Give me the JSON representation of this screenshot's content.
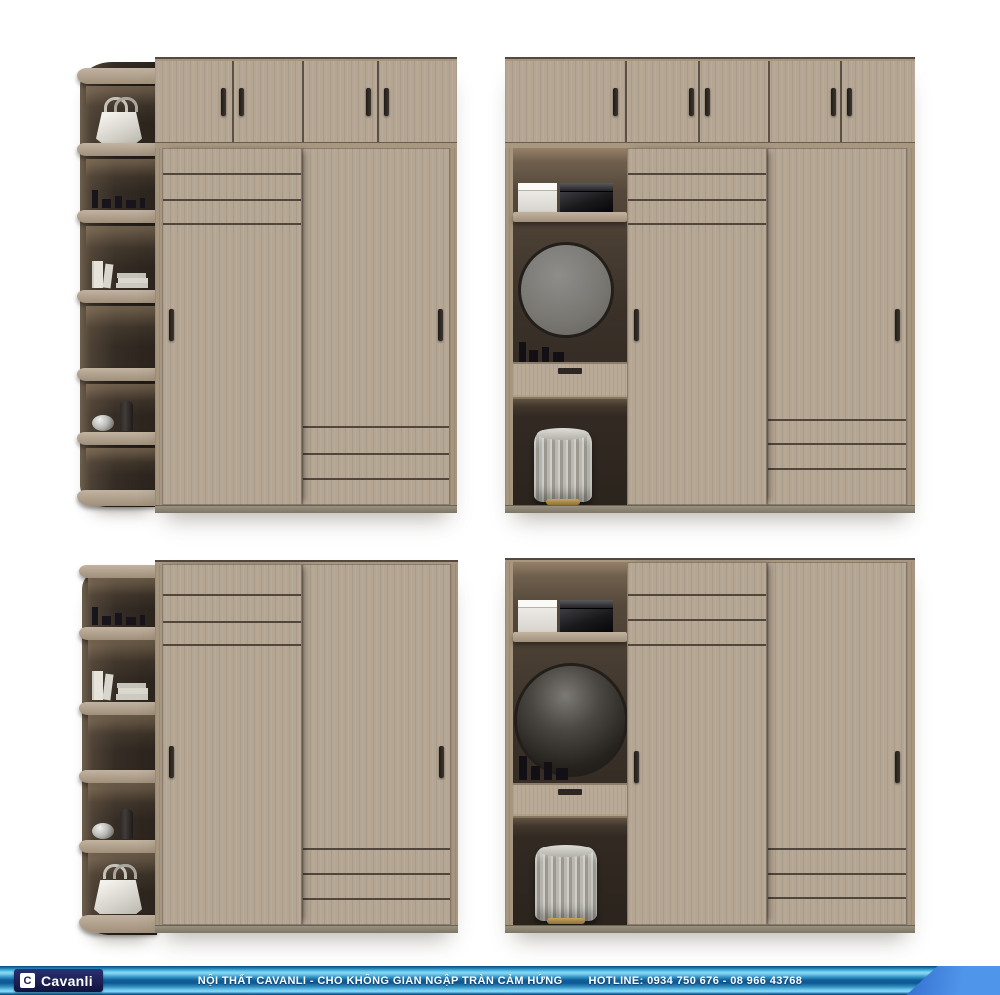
{
  "image": {
    "background": "#ffffff",
    "width": 1000,
    "height": 995
  },
  "brand_bar": {
    "logo_initial": "C",
    "logo_text": "Cavanli",
    "tagline": "NỘI THẤT CAVANLI - CHO KHÔNG GIAN NGẬP TRÀN CẢM HỨNG",
    "hotline": "HOTLINE: 0934 750 676 - 08 966 43768",
    "colors": {
      "bar_light": "#8adcf6",
      "bar_mid": "#11619c",
      "bar_dark": "#0a4a7d",
      "diagonal_accent": "#3a7de0",
      "logo_bg": "#141a4d",
      "text": "#ffffff"
    }
  },
  "palette": {
    "wood_light": "#b5a694",
    "wood_frame": "#a6967f",
    "door_seam": "#50463b",
    "interior_dark": "#2b241d",
    "interior_glow": "#7b6a57",
    "base_strip": "#8d8574",
    "handle": "#2f2a25",
    "mirror_gray": "#7d7a75",
    "stool_fabric": "#bdbbb4",
    "stool_ring": "#a98e55"
  },
  "scenes": [
    {
      "position": "top-left",
      "corner_shelf_items": [
        "handbag",
        "perfume-bottles",
        "books",
        "empty",
        "decor-vases",
        "empty"
      ],
      "top_cabinet_doors": 4,
      "sliding_doors": 2
    },
    {
      "position": "top-right",
      "top_cabinet_doors": 5,
      "sliding_doors": 2,
      "vanity_items": [
        "storage-box-white",
        "storage-box-black",
        "round-mirror",
        "cosmetics",
        "drawer",
        "stool"
      ]
    },
    {
      "position": "bottom-left",
      "corner_shelf_items": [
        "perfume-bottles",
        "books",
        "empty",
        "decor-vases",
        "handbag"
      ],
      "top_cabinet_doors": 0,
      "sliding_doors": 2
    },
    {
      "position": "bottom-right",
      "top_cabinet_doors": 0,
      "sliding_doors": 2,
      "vanity_items": [
        "storage-box-white",
        "storage-box-black",
        "round-mirror",
        "cosmetics",
        "drawer",
        "stool"
      ]
    }
  ]
}
